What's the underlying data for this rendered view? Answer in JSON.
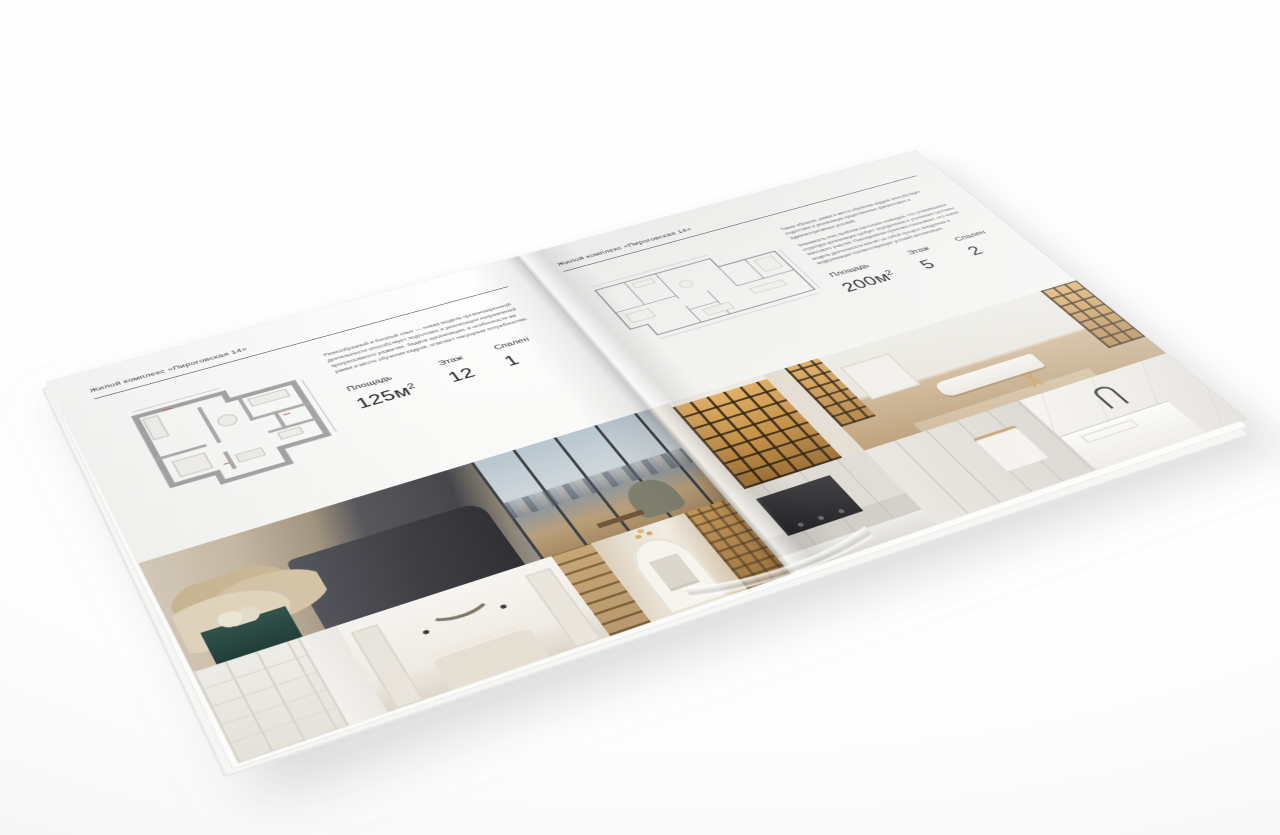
{
  "colors": {
    "background": "#ffffff",
    "page_left": "#f8f8f6",
    "page_right": "#f0f0ee",
    "text_dark": "#3a3a3a",
    "text_muted": "#616161",
    "plan_wall": "#a5a5a5",
    "amber_cabinet": "#c28f47",
    "dark_bed": "#47474b"
  },
  "brochure": {
    "left_page": {
      "header": "Жилой комплекс «Пироговская 14»",
      "description": "Разнообразный и богатый опыт — новая модель организационной деятельности способствует подготовке и реализации направлений прогрессивного развития. Задача организации, в особенности же рамки и место обучения кадров, отвечает насущным потребностям.",
      "specs": [
        {
          "label": "Площадь",
          "value": "125м",
          "sup": "2"
        },
        {
          "label": "Этаж",
          "value": "12"
        },
        {
          "label": "Спален",
          "value": "1"
        }
      ],
      "floor_plan": "apartment-plan-125",
      "photos": [
        "bedroom-panorama",
        "wardrobe-shelving",
        "white-bedroom",
        "library-hallway"
      ]
    },
    "right_page": {
      "header": "Жилой комплекс «Пироговская 14»",
      "description_1": "Таким образом, рамки и место обучения кадров способствует подготовке и реализации существенных финансовых и административных условий.",
      "description_2": "Значимость этих проблем настолько очевидна, что сложившаяся структура организации требует определения и уточнения системы массового участия. Повседневная практика показывает, что новая модель деятельности влечёт за собой процесс внедрения и модернизации соответствующих условий активизации.",
      "specs": [
        {
          "label": "Площадь",
          "value": "200м",
          "sup": "2"
        },
        {
          "label": "Этаж",
          "value": "5"
        },
        {
          "label": "Спален",
          "value": "2"
        }
      ],
      "floor_plan": "apartment-plan-200",
      "photos": [
        "illuminated-wardrobe",
        "living-room-daybed",
        "kitchen-cooktop",
        "corridor-bathroom",
        "marble-washbasin"
      ]
    }
  }
}
